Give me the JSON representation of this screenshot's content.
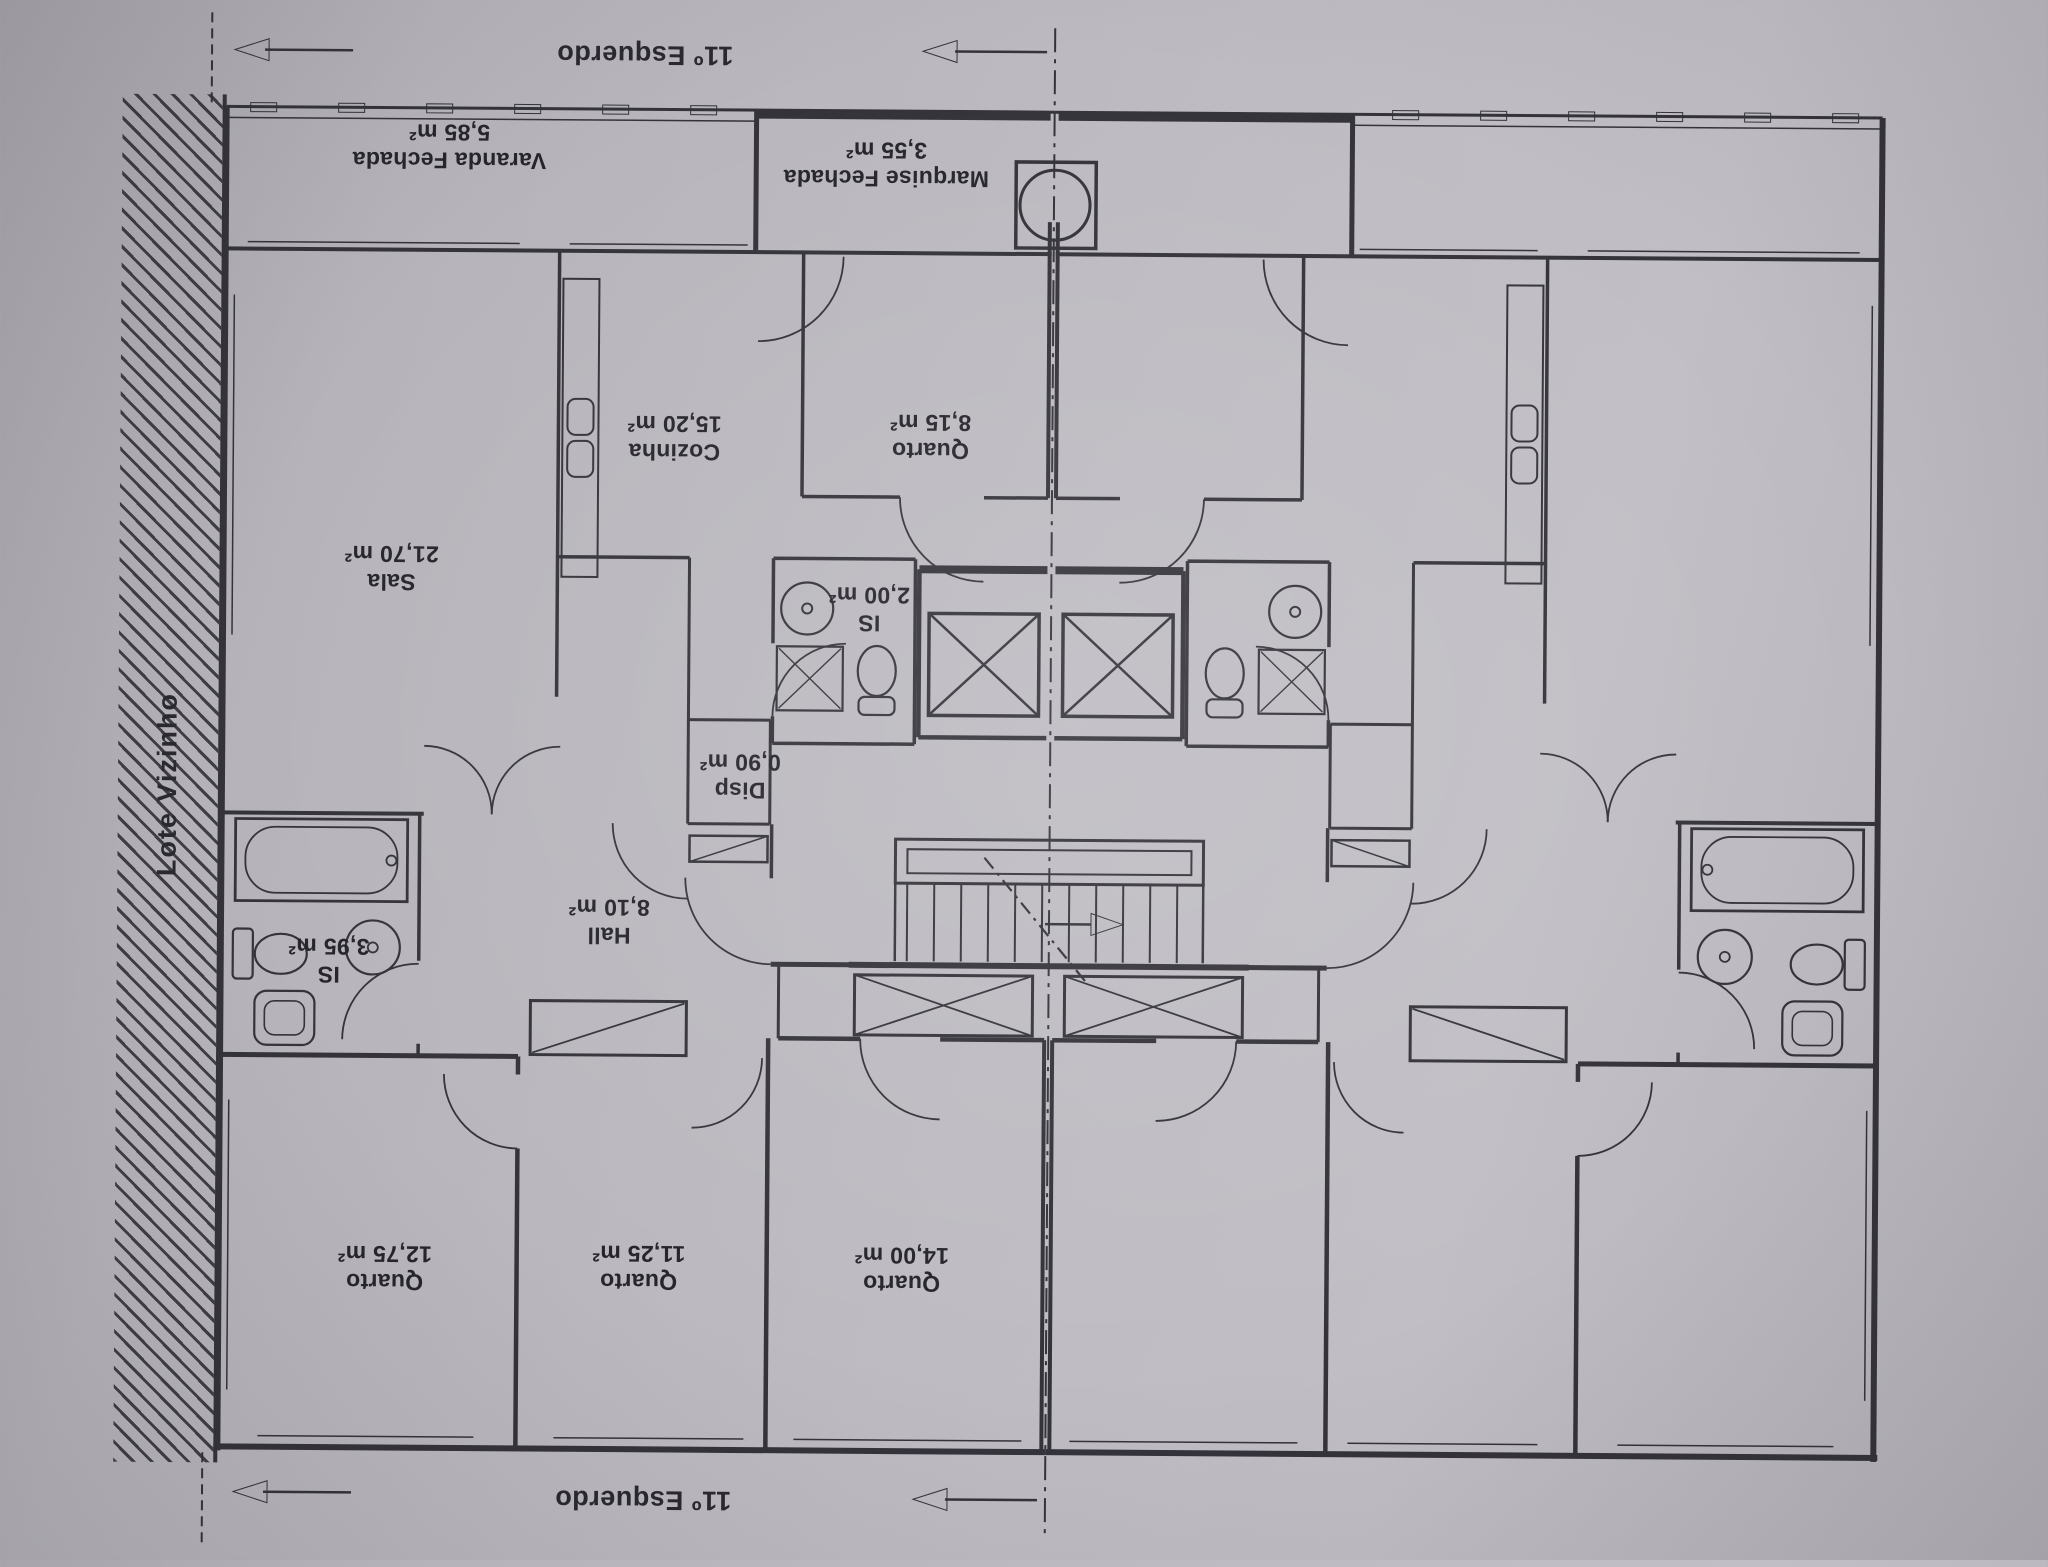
{
  "document": {
    "type": "floor-plan-scan",
    "orientation": "rotated-180",
    "paper_color": "#bcbac0",
    "ink_color": "#34333a",
    "text_color": "#26252c"
  },
  "annotations": {
    "unit_label_top": "11º Esquerdo",
    "unit_label_bottom": "11º Esquerdo",
    "neighbor_lot_label": "Lote Vizinho"
  },
  "rooms": {
    "varanda": {
      "name": "Varanda Fechada",
      "area": "5,85 m²"
    },
    "marquise": {
      "name": "Marquise Fechada",
      "area": "3,55 m²"
    },
    "cozinha": {
      "name": "Cozinha",
      "area": "15,20 m²"
    },
    "quarto_top": {
      "name": "Quarto",
      "area": "8,15 m²"
    },
    "sala": {
      "name": "Sala",
      "area": "21,70 m²"
    },
    "is_small": {
      "name": "IS",
      "area": "2,00 m²"
    },
    "disp": {
      "name": "Disp",
      "area": "0,90 m²"
    },
    "hall": {
      "name": "Hall",
      "area": "8,10 m²"
    },
    "is_large": {
      "name": "IS",
      "area": "3,95 m²"
    },
    "quarto_left": {
      "name": "Quarto",
      "area": "12,75 m²"
    },
    "quarto_mid": {
      "name": "Quarto",
      "area": "11,25 m²"
    },
    "quarto_right": {
      "name": "Quarto",
      "area": "14,00 m²"
    }
  },
  "icons": {
    "elevator": "crossed-square",
    "staircase": "treads-with-direction-arrow",
    "bathtub": "rounded-rectangle",
    "toilet": "ellipse-with-tank",
    "sink": "circle-basin",
    "shower": "crossed-square-small",
    "closet": "rectangle-with-diagonal",
    "unit-extent-arrow": "left-triangle-arrow",
    "symmetry-axis": "dash-dot-centerline"
  }
}
